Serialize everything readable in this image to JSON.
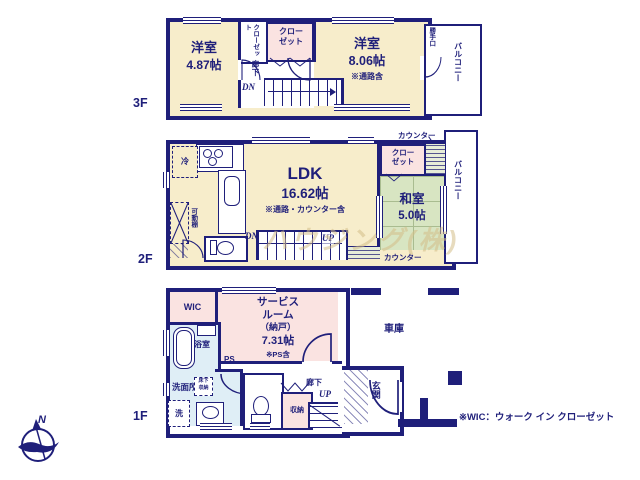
{
  "colors": {
    "wall": "#1f1f7a",
    "room": "#f7edcb",
    "closet_pink": "#fae3e1",
    "tatami_green": "#d8e5c2",
    "wet_blue": "#dfeef6",
    "paper": "#ffffff"
  },
  "compass": {
    "n": "N"
  },
  "footnote": "※WIC：ウォーク イン クローゼット",
  "watermark": "ハウジング(株)",
  "f3": {
    "label": "3F",
    "left_room": {
      "name": "洋室",
      "size": "4.87帖"
    },
    "right_room": {
      "name": "洋室",
      "size": "8.06帖",
      "note": "※通路含"
    },
    "closet_a": "クローゼット",
    "closet_b": "クローゼット",
    "hall": "廊下",
    "dn": "DN",
    "back_door": "勝手口",
    "balcony": "バルコニー"
  },
  "f2": {
    "label": "2F",
    "ldk_name": "LDK",
    "ldk_size": "16.62帖",
    "ldk_note": "※通路・カウンター含",
    "washitsu_name": "和室",
    "washitsu_size": "5.0帖",
    "closet": "クローゼット",
    "counter_top": "カウンター",
    "counter_bottom": "カウンター",
    "fridge": "冷",
    "shelf": "可動棚",
    "dn": "DN",
    "up": "UP",
    "balcony": "バルコニー"
  },
  "f1": {
    "label": "1F",
    "wic": "WIC",
    "service_line1": "サービス",
    "service_line2": "ルーム",
    "service_line3": "（納戸）",
    "service_size": "7.31帖",
    "service_note": "※PS含",
    "ps": "PS",
    "bath": "浴室",
    "washroom": "洗面所",
    "laundry": "洗",
    "underfloor_line1": "床下",
    "underfloor_line2": "収納",
    "storage": "収納",
    "hall": "廊下",
    "up": "UP",
    "entrance": "玄関",
    "garage": "車庫"
  }
}
